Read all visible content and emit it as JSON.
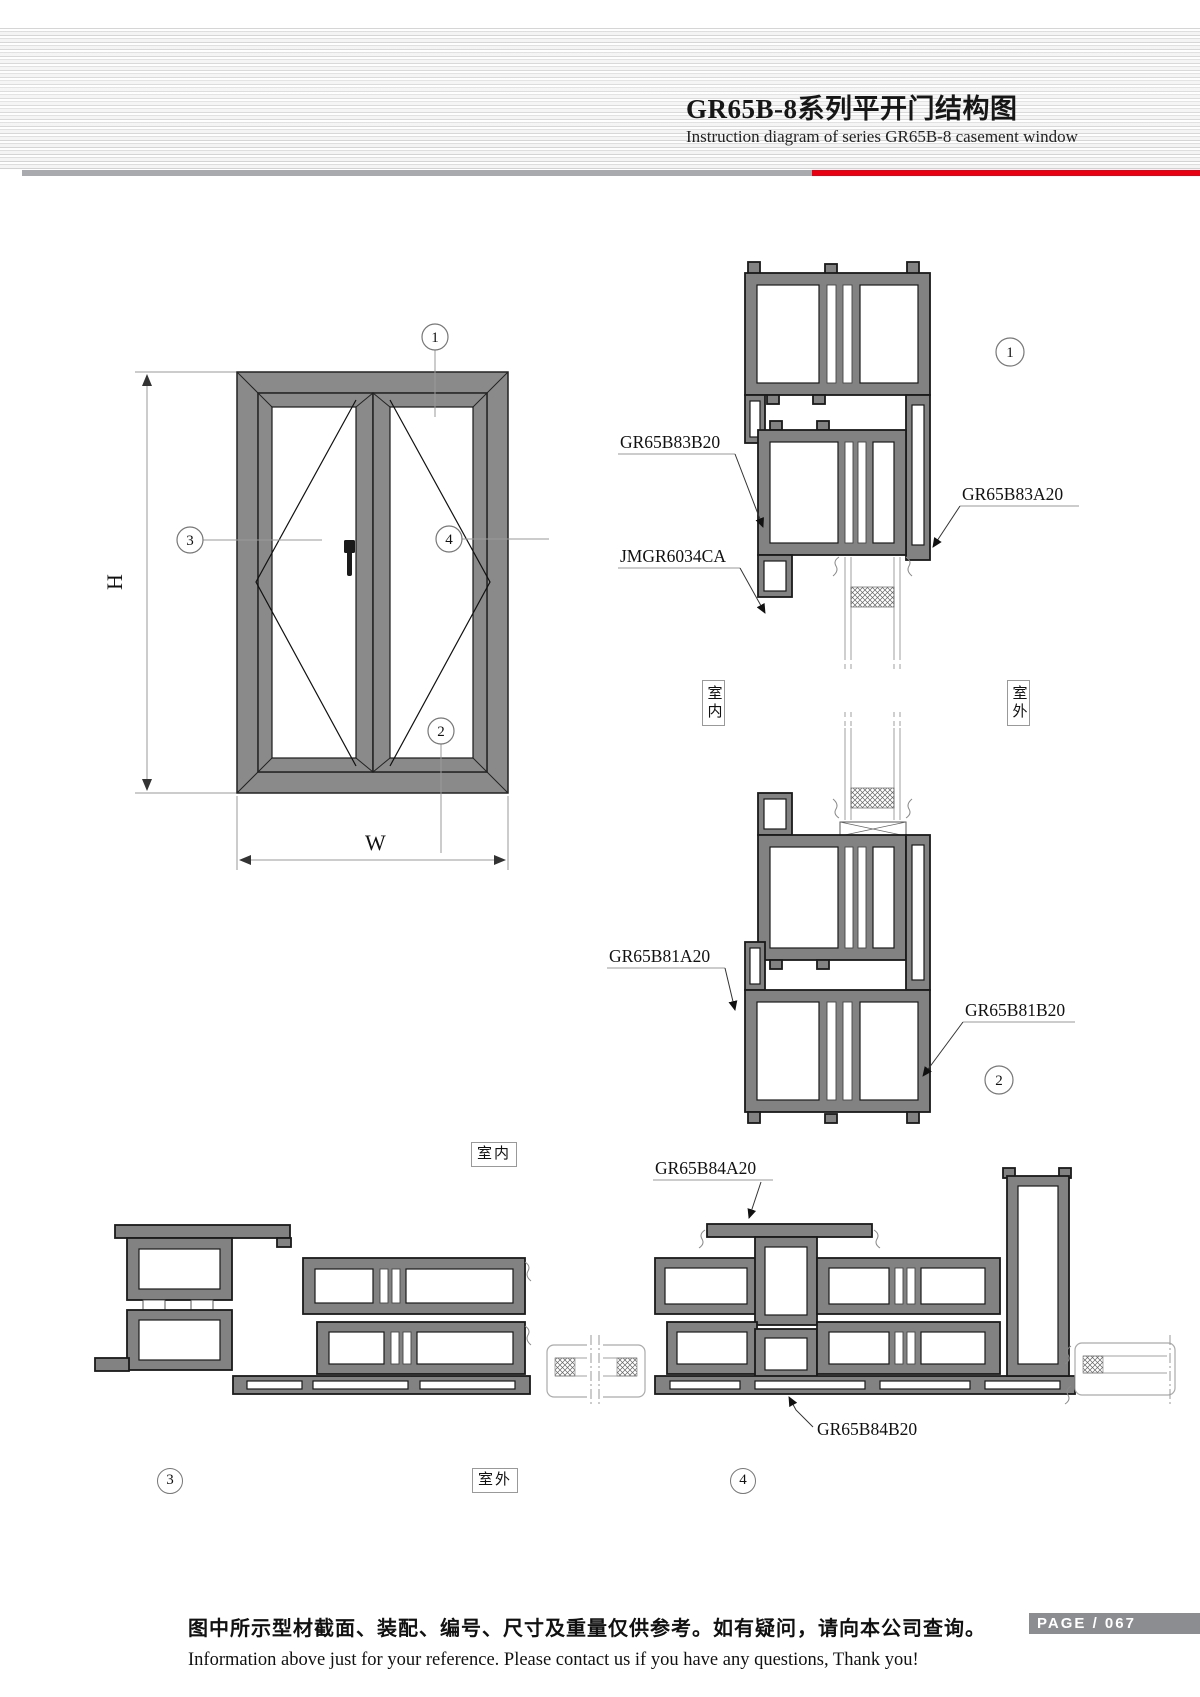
{
  "header": {
    "title": "GR65B-8系列平开门结构图",
    "subtitle": "Instruction diagram of series GR65B-8 casement window"
  },
  "elevation": {
    "dim_height": "H",
    "dim_width": "W"
  },
  "markers": {
    "m1": "1",
    "m2": "2",
    "m3": "3",
    "m4": "4"
  },
  "part_labels": {
    "s1_left_top": "GR65B83B20",
    "s1_left_bottom": "JMGR6034CA",
    "s1_right": "GR65B83A20",
    "s2_left": "GR65B81A20",
    "s2_right": "GR65B81B20",
    "s34_top": "GR65B84A20",
    "s34_bottom": "GR65B84B20"
  },
  "location_labels": {
    "indoor": "室内",
    "outdoor": "室外"
  },
  "footer": {
    "note_zh": "图中所示型材截面、装配、编号、尺寸及重量仅供参考。如有疑问，请向本公司查询。",
    "note_en": "Information above just for your reference. Please contact us if you have any questions, Thank you!",
    "page_label": "PAGE / 067"
  },
  "colors": {
    "accent_red": "#e60012",
    "profile_gray": "#828282",
    "page_bar_gray": "#8b8d90"
  }
}
